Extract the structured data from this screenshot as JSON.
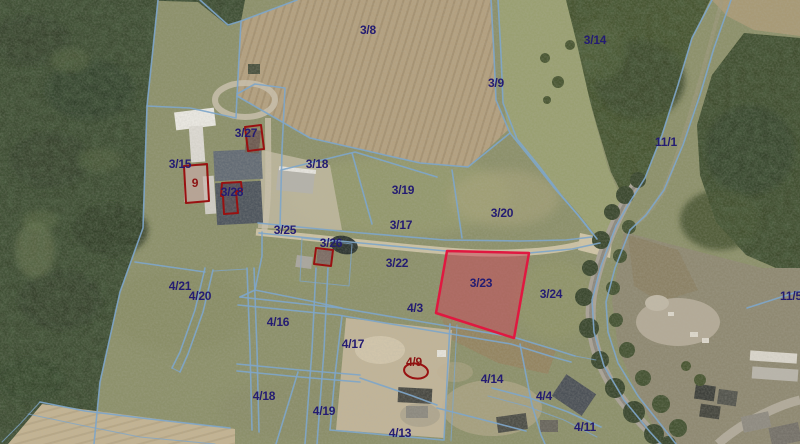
{
  "map": {
    "description": "Cadastral parcel boundaries over aerial orthophoto",
    "selected_parcel": "3/23",
    "colors": {
      "parcel_boundary": "#7fa6c9",
      "parcel_label": "#241c72",
      "building_label": "#8c1212",
      "selected_outline": "#e01840",
      "selected_fill": "rgba(204,70,90,0.5)",
      "building_outline": "#991111"
    },
    "parcel_labels": [
      {
        "text": "3/8",
        "x": 368,
        "y": 30,
        "color": "navy"
      },
      {
        "text": "3/14",
        "x": 595,
        "y": 40,
        "color": "navy"
      },
      {
        "text": "3/9",
        "x": 496,
        "y": 83,
        "color": "navy"
      },
      {
        "text": "11/1",
        "x": 666,
        "y": 142,
        "color": "navy"
      },
      {
        "text": "3/27",
        "x": 246,
        "y": 133,
        "color": "navy"
      },
      {
        "text": "3/15",
        "x": 180,
        "y": 164,
        "color": "navy"
      },
      {
        "text": "9",
        "x": 195,
        "y": 183,
        "color": "red"
      },
      {
        "text": "3/28",
        "x": 232,
        "y": 192,
        "color": "navy"
      },
      {
        "text": "3/18",
        "x": 317,
        "y": 164,
        "color": "navy"
      },
      {
        "text": "3/19",
        "x": 403,
        "y": 190,
        "color": "navy"
      },
      {
        "text": "3/20",
        "x": 502,
        "y": 213,
        "color": "navy"
      },
      {
        "text": "3/17",
        "x": 401,
        "y": 225,
        "color": "navy"
      },
      {
        "text": "3/25",
        "x": 285,
        "y": 230,
        "color": "navy"
      },
      {
        "text": "3/26",
        "x": 331,
        "y": 243,
        "color": "navy"
      },
      {
        "text": "3/22",
        "x": 397,
        "y": 263,
        "color": "navy"
      },
      {
        "text": "3/23",
        "x": 481,
        "y": 283,
        "color": "navy"
      },
      {
        "text": "3/24",
        "x": 551,
        "y": 294,
        "color": "navy"
      },
      {
        "text": "11/5",
        "x": 791,
        "y": 296,
        "color": "navy"
      },
      {
        "text": "4/21",
        "x": 180,
        "y": 286,
        "color": "navy"
      },
      {
        "text": "4/20",
        "x": 200,
        "y": 296,
        "color": "navy"
      },
      {
        "text": "4/3",
        "x": 415,
        "y": 308,
        "color": "navy"
      },
      {
        "text": "4/16",
        "x": 278,
        "y": 322,
        "color": "navy"
      },
      {
        "text": "4/17",
        "x": 353,
        "y": 344,
        "color": "navy"
      },
      {
        "text": "4/9",
        "x": 414,
        "y": 362,
        "color": "red"
      },
      {
        "text": "4/14",
        "x": 492,
        "y": 379,
        "color": "navy"
      },
      {
        "text": "4/4",
        "x": 544,
        "y": 396,
        "color": "navy"
      },
      {
        "text": "4/18",
        "x": 264,
        "y": 396,
        "color": "navy"
      },
      {
        "text": "4/19",
        "x": 324,
        "y": 411,
        "color": "navy"
      },
      {
        "text": "4/13",
        "x": 400,
        "y": 433,
        "color": "navy"
      },
      {
        "text": "4/11",
        "x": 585,
        "y": 427,
        "color": "navy"
      }
    ]
  }
}
